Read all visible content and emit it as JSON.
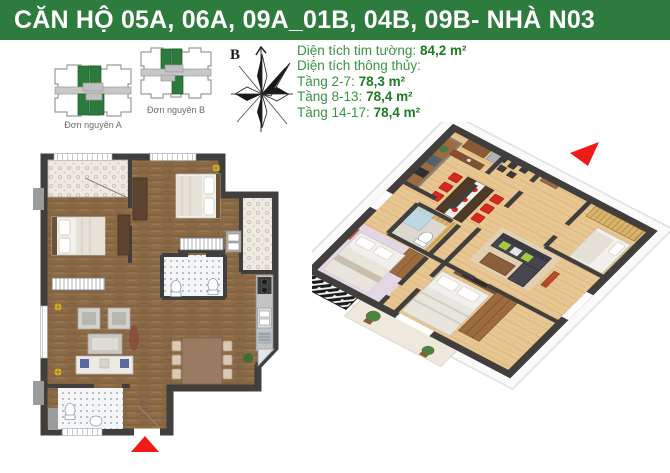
{
  "header": {
    "title": "CĂN HỘ 05A, 06A, 09A_01B, 04B, 09B- NHÀ N03"
  },
  "site_plan": {
    "building_a_label": "Đơn nguyên A",
    "building_b_label": "Đơn nguyên B"
  },
  "compass": {
    "north_label": "B"
  },
  "area_info": {
    "gross_label": "Diện tích tim tường:",
    "gross_value": "84,2 m²",
    "net_label": "Diện tích thông thủy:",
    "floors": [
      {
        "label": "Tầng 2-7:",
        "value": "78,3 m²"
      },
      {
        "label": "Tầng 8-13:",
        "value": "78,4 m²"
      },
      {
        "label": "Tầng 14-17:",
        "value": "78,4 m²"
      }
    ]
  },
  "icons": {
    "compass": "compass-rose-icon",
    "entrance_2d": "entrance-arrow-marker",
    "entrance_3d": "entrance-arrow-marker"
  },
  "colors": {
    "header_green": "#2e7b3e",
    "unit_green": "#2c7a3c",
    "label_green": "#3a9440",
    "value_green": "#1d7c21",
    "accent_red": "#ed1c16",
    "wall_dark": "#413f3d"
  }
}
